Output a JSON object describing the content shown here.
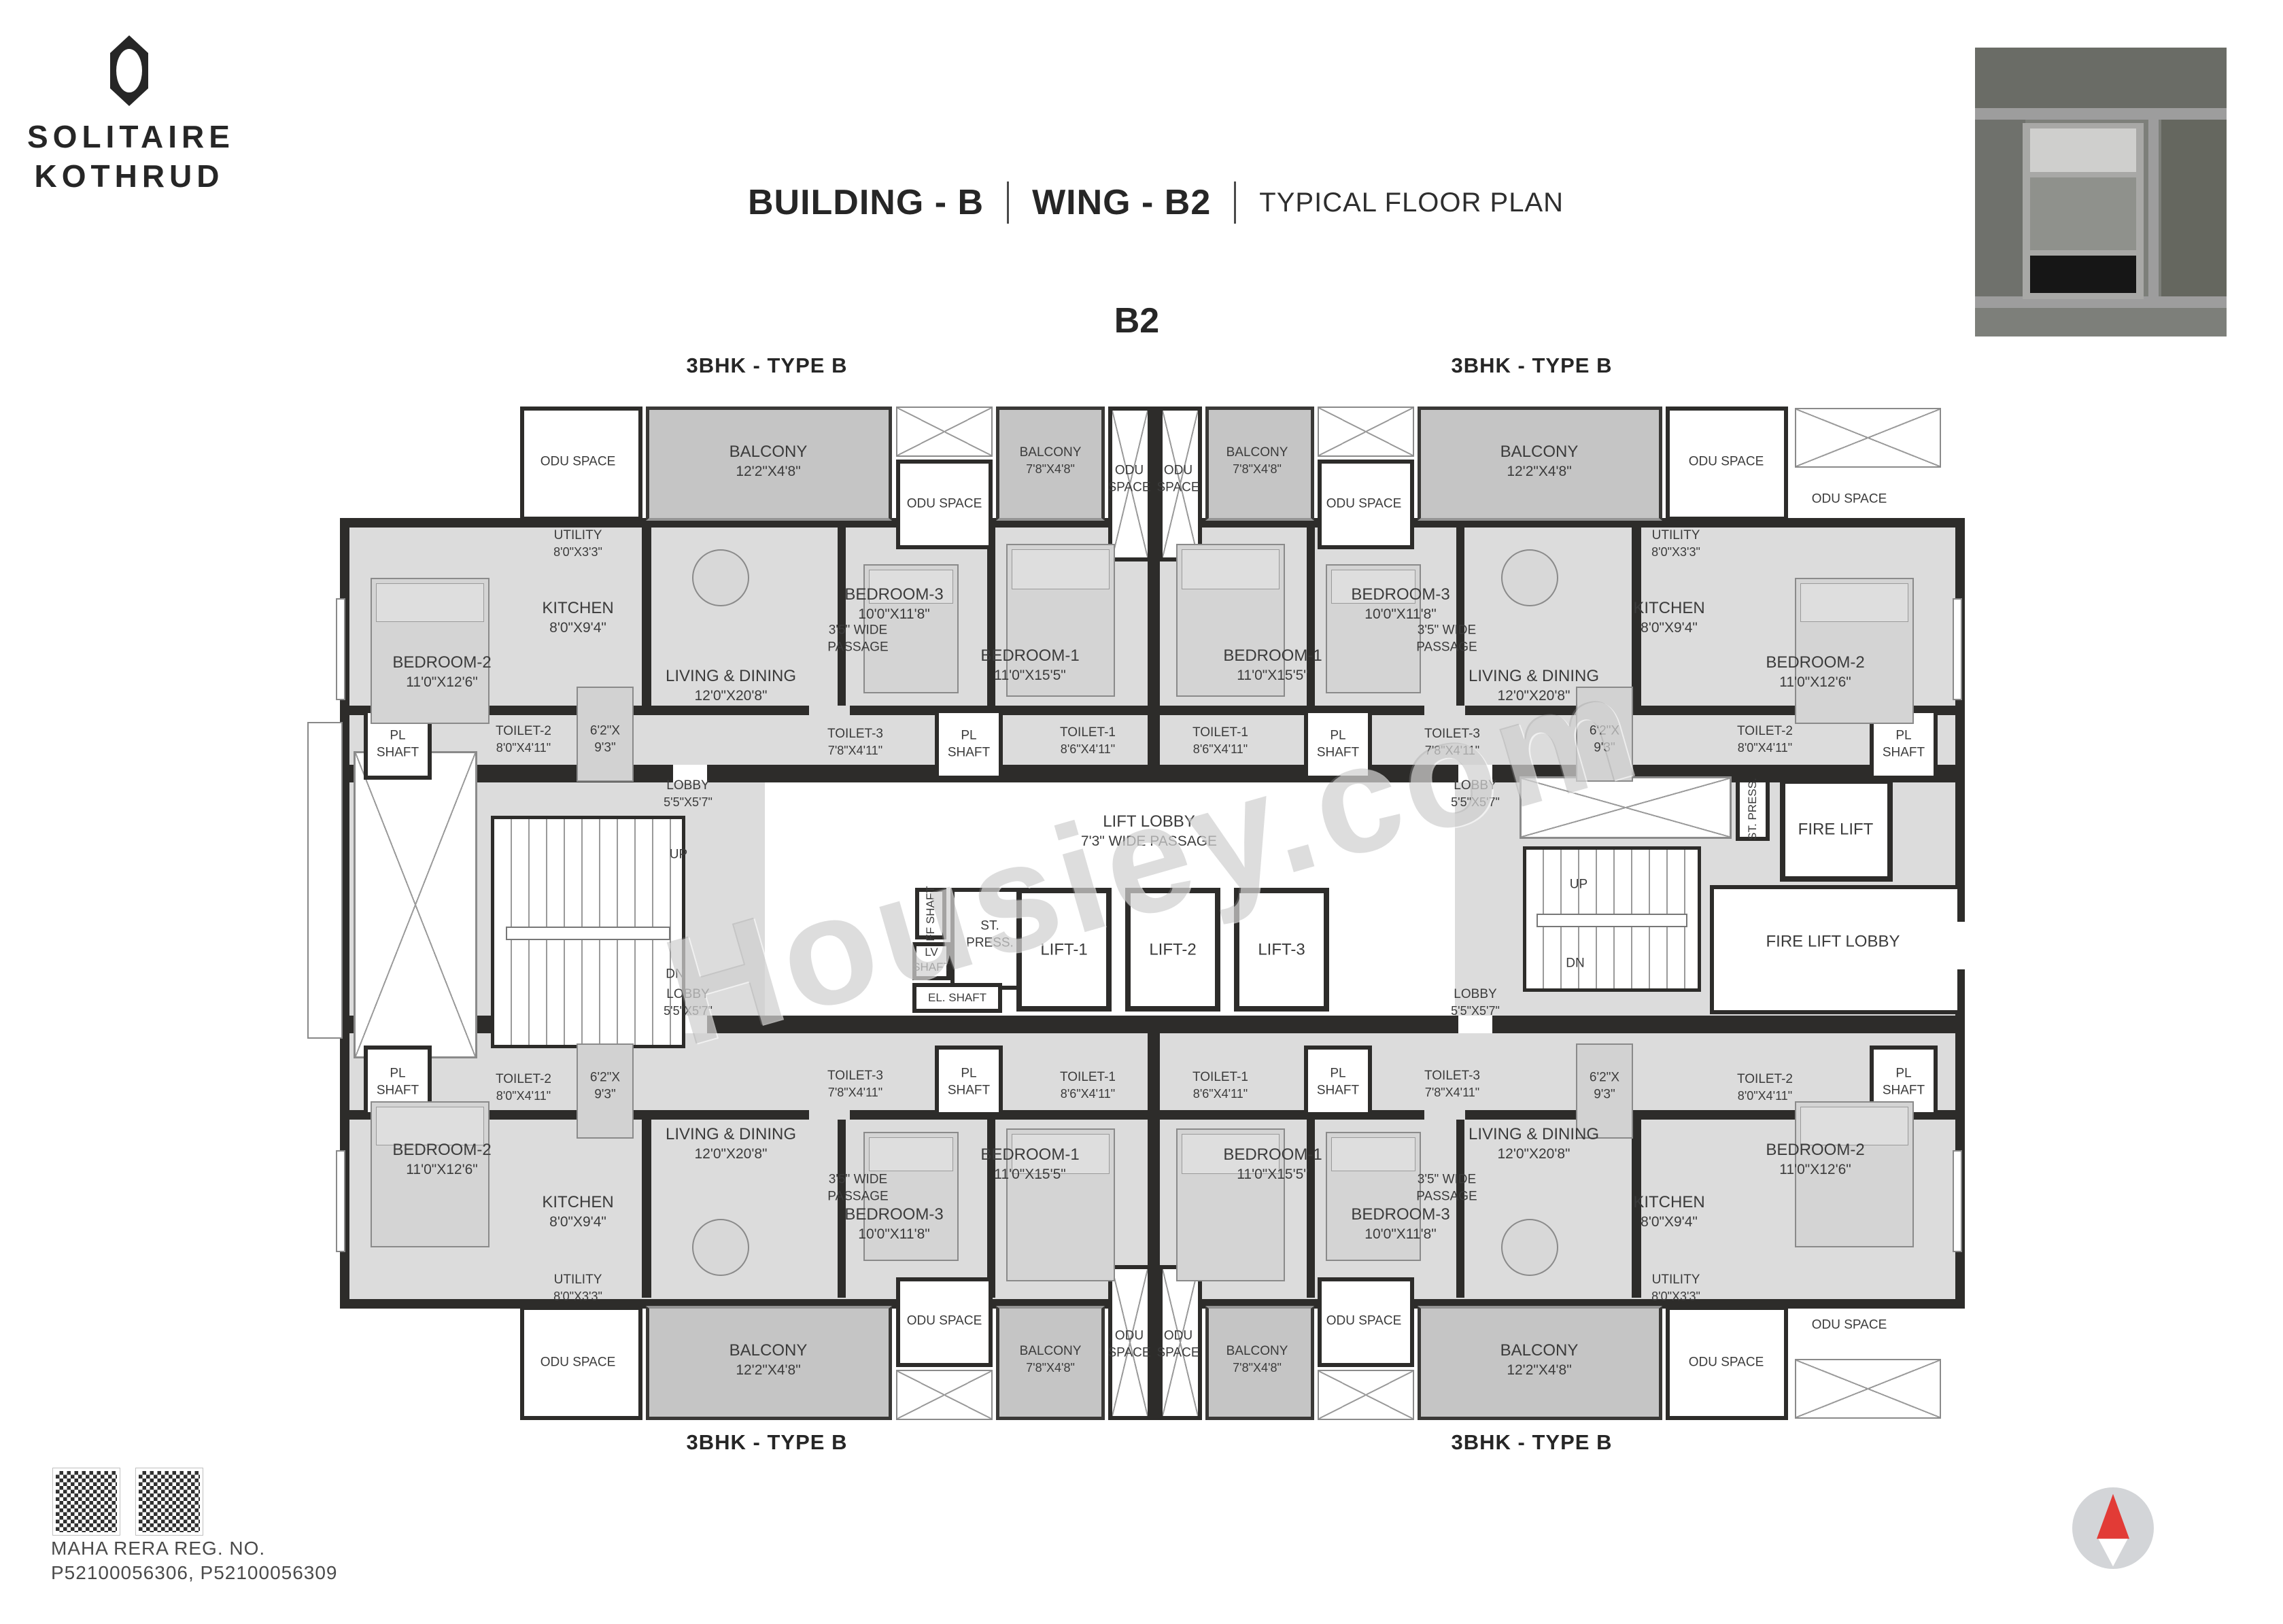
{
  "brand": {
    "line1": "SOLITAIRE",
    "line2": "KOTHRUD"
  },
  "title": {
    "building": "BUILDING - B",
    "wing": "WING - B2",
    "plan_type": "TYPICAL FLOOR PLAN"
  },
  "wing_code": "B2",
  "unit_type": "3BHK - TYPE B",
  "watermark": "Housiey.com",
  "footer": {
    "rera_label": "MAHA RERA REG. NO.",
    "rera_numbers": "P52100056306, P52100056309"
  },
  "rooms": {
    "odu": "ODU SPACE",
    "balcony_lg": {
      "label": "BALCONY",
      "dims": "12'2\"X4'8\""
    },
    "balcony_sm": {
      "label": "BALCONY",
      "dims": "7'8\"X4'8\""
    },
    "utility": {
      "label": "UTILITY",
      "dims": "8'0\"X3'3\""
    },
    "kitchen": {
      "label": "KITCHEN",
      "dims": "8'0\"X9'4\""
    },
    "bedroom1": {
      "label": "BEDROOM-1",
      "dims": "11'0\"X15'5\""
    },
    "bedroom2": {
      "label": "BEDROOM-2",
      "dims": "11'0\"X12'6\""
    },
    "bedroom3": {
      "label": "BEDROOM-3",
      "dims": "10'0\"X11'8\""
    },
    "living": {
      "label": "LIVING & DINING",
      "dims": "12'0\"X20'8\""
    },
    "dining_nook": {
      "line1": "6'2\"X",
      "line2": "9'3\""
    },
    "passage": {
      "line1": "3'5\" WIDE",
      "line2": "PASSAGE"
    },
    "toilet1": {
      "label": "TOILET-1",
      "dims": "8'6\"X4'11\""
    },
    "toilet2": {
      "label": "TOILET-2",
      "dims": "8'0\"X4'11\""
    },
    "toilet3": {
      "label": "TOILET-3",
      "dims": "7'8\"X4'11\""
    },
    "pl_shaft": {
      "line1": "PL",
      "line2": "SHAFT"
    },
    "lobby": {
      "label": "LOBBY",
      "dims": "5'5\"X5'7\""
    },
    "lift_lobby": {
      "line1": "LIFT LOBBY",
      "line2": "7'3\" WIDE PASSAGE"
    },
    "lifts": [
      "LIFT-1",
      "LIFT-2",
      "LIFT-3"
    ],
    "ff_shaft": "FF SHAFT",
    "st_press": {
      "line1": "ST.",
      "line2": "PRESS."
    },
    "st_press_full": "ST. PRESS.",
    "lv_shaft": {
      "line1": "LV",
      "line2": "SHAFT"
    },
    "el_shaft": "EL. SHAFT",
    "fire_lift": "FIRE LIFT",
    "fire_lift_lobby": "FIRE LIFT LOBBY",
    "up": "UP",
    "dn": "DN"
  }
}
